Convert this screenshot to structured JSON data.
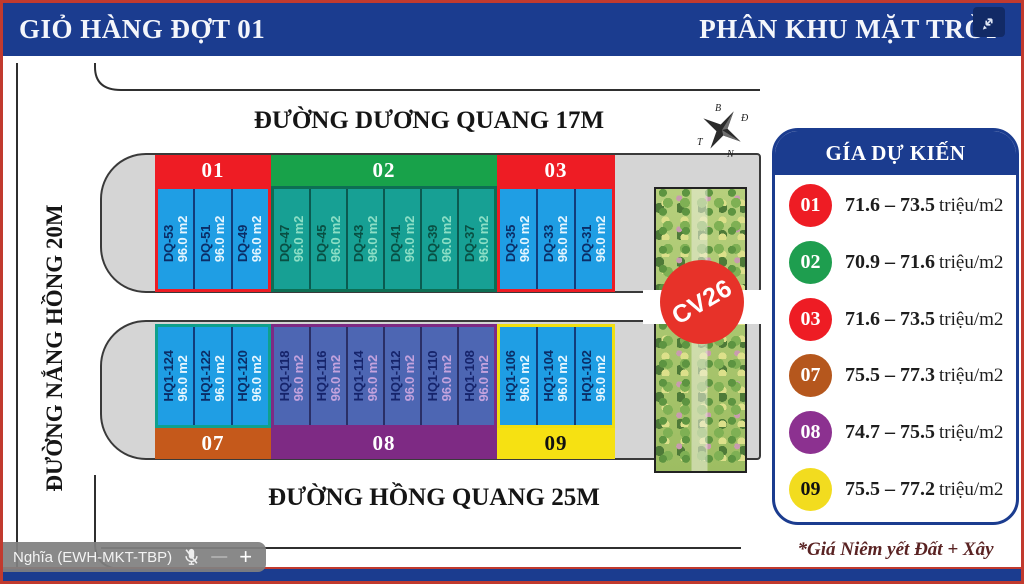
{
  "header": {
    "left_title": "GIỎ HÀNG ĐỢT 01",
    "right_title": "PHÂN KHU MẶT TRỜI"
  },
  "streets": {
    "top": "ĐƯỜNG DƯƠNG QUANG 17M",
    "left": "ĐƯỜNG NẮNG HỒNG 20M",
    "bottom": "ĐƯỜNG HỒNG QUANG 25M"
  },
  "compass": {
    "north": "B",
    "east": "Đ",
    "south": "N",
    "west": "T"
  },
  "park": {
    "label": "CV26",
    "color": "#e73229"
  },
  "map": {
    "blocks": [
      {
        "id": "01",
        "row": "top",
        "bar_color": "#ee1c24",
        "bar_text_color": "#ffffff",
        "outline": "#ee1c24",
        "plot_bg": "#1f9ee4",
        "separator": "#123c7a",
        "plot_id_color": "#0b2d66",
        "plot_area_color": "#e6f6ff",
        "plots": [
          {
            "id": "DQ-53",
            "area": "96.0 m2"
          },
          {
            "id": "DQ-51",
            "area": "96.0 m2"
          },
          {
            "id": "DQ-49",
            "area": "96.0 m2"
          }
        ]
      },
      {
        "id": "02",
        "row": "top",
        "bar_color": "#18a24a",
        "bar_text_color": "#ffffff",
        "outline": "#0d6e54",
        "plot_bg": "#17a094",
        "separator": "#0b5a50",
        "plot_id_color": "#094f43",
        "plot_area_color": "#8ddfc6",
        "plots": [
          {
            "id": "DQ-47",
            "area": "96.0 m2"
          },
          {
            "id": "DQ-45",
            "area": "96.0 m2"
          },
          {
            "id": "DQ-43",
            "area": "96.0 m2"
          },
          {
            "id": "DQ-41",
            "area": "96.0 m2"
          },
          {
            "id": "DQ-39",
            "area": "96.0 m2"
          },
          {
            "id": "DQ-37",
            "area": "96.0 m2"
          }
        ]
      },
      {
        "id": "03",
        "row": "top",
        "bar_color": "#ee1c24",
        "bar_text_color": "#ffffff",
        "outline": "#ee1c24",
        "plot_bg": "#1f9ee4",
        "separator": "#123c7a",
        "plot_id_color": "#0b2d66",
        "plot_area_color": "#e6f6ff",
        "plots": [
          {
            "id": "DQ-35",
            "area": "96.0 m2"
          },
          {
            "id": "DQ-33",
            "area": "96.0 m2"
          },
          {
            "id": "DQ-31",
            "area": "96.0 m2"
          }
        ]
      },
      {
        "id": "07",
        "row": "bottom",
        "bar_color": "#c5591b",
        "bar_text_color": "#ffffff",
        "outline": "#0fa08c",
        "plot_bg": "#1f9ee4",
        "separator": "#123c7a",
        "plot_id_color": "#0b2d66",
        "plot_area_color": "#e6f6ff",
        "plots": [
          {
            "id": "HQ1-124",
            "area": "96.0 m2"
          },
          {
            "id": "HQ1-122",
            "area": "96.0 m2"
          },
          {
            "id": "HQ1-120",
            "area": "96.0 m2"
          }
        ]
      },
      {
        "id": "08",
        "row": "bottom",
        "bar_color": "#7e2a84",
        "bar_text_color": "#ffffff",
        "outline": "#7e2a84",
        "plot_bg": "#4d66b3",
        "separator": "#2a2f66",
        "plot_id_color": "#16246b",
        "plot_area_color": "#c4a3de",
        "plots": [
          {
            "id": "HQ1-118",
            "area": "96.0 m2"
          },
          {
            "id": "HQ1-116",
            "area": "96.0 m2"
          },
          {
            "id": "HQ1-114",
            "area": "96.0 m2"
          },
          {
            "id": "HQ1-112",
            "area": "96.0 m2"
          },
          {
            "id": "HQ1-110",
            "area": "96.0 m2"
          },
          {
            "id": "HQ1-108",
            "area": "96.0 m2"
          }
        ]
      },
      {
        "id": "09",
        "row": "bottom",
        "bar_color": "#f6e112",
        "bar_text_color": "#111111",
        "outline": "#f0df10",
        "plot_bg": "#1f9ee4",
        "separator": "#123c7a",
        "plot_id_color": "#0b2d66",
        "plot_area_color": "#e6f6ff",
        "plots": [
          {
            "id": "HQ1-106",
            "area": "96.0 m2"
          },
          {
            "id": "HQ1-104",
            "area": "96.0 m2"
          },
          {
            "id": "HQ1-102",
            "area": "96.0 m2"
          }
        ]
      }
    ]
  },
  "legend": {
    "title": "GÍA DỰ KIẾN",
    "rows": [
      {
        "zone": "01",
        "color": "#ee1c24",
        "text_color": "#ffffff",
        "price": "71.6 – 73.5",
        "unit": "triệu/m2"
      },
      {
        "zone": "02",
        "color": "#1e9e4f",
        "text_color": "#ffffff",
        "price": "70.9 – 71.6",
        "unit": "triệu/m2"
      },
      {
        "zone": "03",
        "color": "#ee1c24",
        "text_color": "#ffffff",
        "price": "71.6 – 73.5",
        "unit": "triệu/m2"
      },
      {
        "zone": "07",
        "color": "#b5571d",
        "text_color": "#ffffff",
        "price": "75.5 – 77.3",
        "unit": "triệu/m2"
      },
      {
        "zone": "08",
        "color": "#8c3190",
        "text_color": "#ffffff",
        "price": "74.7 – 75.5",
        "unit": "triệu/m2"
      },
      {
        "zone": "09",
        "color": "#f2dc1f",
        "text_color": "#111111",
        "price": "75.5 – 77.2",
        "unit": "triệu/m2"
      }
    ],
    "footnote": "*Giá Niêm yết Đất + Xây"
  },
  "overlay": {
    "participant": "Nghĩa (EWH-MKT-TBP)",
    "minus": "—",
    "plus": "+"
  }
}
